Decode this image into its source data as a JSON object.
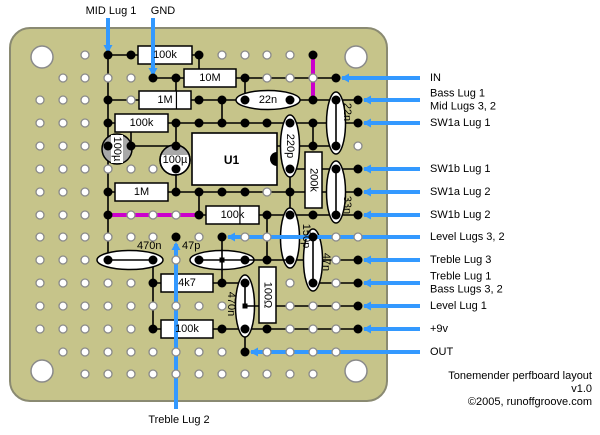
{
  "meta": {
    "title_line1": "Tonemender perfboard layout",
    "title_line2": "v1.0",
    "title_line3": "©2005, runoffgroove.com"
  },
  "colors": {
    "board": "#C6C48A",
    "board_edge": "#8A8A72",
    "trace": "#000000",
    "jumper": "#CC00CC",
    "lead": "#3399FF",
    "hole_ring": "#8A8A8A",
    "hole_fill": "#FFFFFF",
    "dot": "#000000",
    "component_fill": "#FFFFFF",
    "crescent": "#A8A8A8",
    "text": "#000000"
  },
  "board": {
    "x": 10,
    "y": 28,
    "w": 377,
    "h": 373,
    "r": 20,
    "screws": [
      [
        42,
        57
      ],
      [
        356,
        57
      ],
      [
        42,
        371
      ],
      [
        356,
        371
      ]
    ],
    "screw_r": 11
  },
  "grid": {
    "cols": [
      40,
      63,
      85,
      108,
      131,
      153,
      176,
      199,
      222,
      245,
      267,
      290,
      313,
      336,
      358
    ],
    "rows": [
      55,
      78,
      100,
      123,
      146,
      169,
      192,
      215,
      237,
      260,
      283,
      306,
      329,
      352,
      374
    ],
    "hole_r": 4,
    "skip": [
      [
        0,
        0
      ],
      [
        1,
        0
      ],
      [
        0,
        1
      ],
      [
        13,
        0
      ],
      [
        14,
        0
      ],
      [
        14,
        1
      ],
      [
        0,
        13
      ],
      [
        0,
        14
      ],
      [
        1,
        14
      ],
      [
        14,
        13
      ],
      [
        13,
        14
      ],
      [
        14,
        14
      ],
      [
        5,
        4
      ]
    ]
  },
  "traces_under": [
    [
      108,
      55,
      199,
      55
    ],
    [
      153,
      78,
      336,
      78
    ],
    [
      108,
      100,
      358,
      100
    ],
    [
      108,
      123,
      358,
      123
    ],
    [
      108,
      146,
      176,
      146
    ],
    [
      277,
      146,
      336,
      146
    ],
    [
      290,
      169,
      358,
      169
    ],
    [
      108,
      192,
      358,
      192
    ],
    [
      199,
      215,
      358,
      215
    ],
    [
      153,
      283,
      245,
      283
    ],
    [
      290,
      260,
      358,
      260
    ],
    [
      313,
      283,
      358,
      283
    ],
    [
      153,
      329,
      358,
      329
    ],
    [
      108,
      55,
      108,
      260
    ],
    [
      131,
      123,
      131,
      146
    ],
    [
      153,
      260,
      153,
      329
    ],
    [
      176,
      78,
      176,
      100
    ],
    [
      176,
      123,
      176,
      192
    ],
    [
      199,
      55,
      199,
      78
    ],
    [
      199,
      192,
      199,
      215
    ],
    [
      222,
      100,
      222,
      123
    ],
    [
      245,
      78,
      245,
      100
    ],
    [
      245,
      329,
      245,
      352
    ],
    [
      267,
      215,
      267,
      260
    ],
    [
      290,
      169,
      290,
      215
    ],
    [
      313,
      123,
      313,
      146
    ]
  ],
  "traces_over": [
    [
      108,
      260,
      153,
      260
    ],
    [
      199,
      260,
      290,
      260
    ],
    [
      222,
      237,
      222,
      283
    ],
    [
      336,
      100,
      336,
      146
    ],
    [
      336,
      169,
      336,
      215
    ],
    [
      313,
      237,
      313,
      283
    ],
    [
      245,
      283,
      245,
      306
    ],
    [
      245,
      306,
      358,
      306
    ]
  ],
  "jumpers": [
    [
      313,
      55,
      313,
      100
    ],
    [
      108,
      215,
      199,
      215
    ]
  ],
  "dots": [
    [
      108,
      55
    ],
    [
      131,
      55
    ],
    [
      199,
      55
    ],
    [
      313,
      55
    ],
    [
      153,
      78
    ],
    [
      176,
      78
    ],
    [
      245,
      78
    ],
    [
      336,
      78
    ],
    [
      108,
      100
    ],
    [
      199,
      100
    ],
    [
      222,
      100
    ],
    [
      245,
      100
    ],
    [
      290,
      100
    ],
    [
      313,
      100
    ],
    [
      336,
      100
    ],
    [
      358,
      100
    ],
    [
      108,
      123
    ],
    [
      176,
      123
    ],
    [
      199,
      123
    ],
    [
      222,
      123
    ],
    [
      245,
      123
    ],
    [
      267,
      123
    ],
    [
      290,
      123
    ],
    [
      313,
      123
    ],
    [
      358,
      123
    ],
    [
      108,
      146
    ],
    [
      131,
      146
    ],
    [
      176,
      146
    ],
    [
      313,
      146
    ],
    [
      336,
      146
    ],
    [
      176,
      169
    ],
    [
      290,
      169
    ],
    [
      336,
      169
    ],
    [
      358,
      169
    ],
    [
      108,
      192
    ],
    [
      176,
      192
    ],
    [
      199,
      192
    ],
    [
      222,
      192
    ],
    [
      245,
      192
    ],
    [
      290,
      192
    ],
    [
      358,
      192
    ],
    [
      108,
      215
    ],
    [
      199,
      215
    ],
    [
      267,
      215
    ],
    [
      290,
      215
    ],
    [
      313,
      215
    ],
    [
      336,
      215
    ],
    [
      358,
      215
    ],
    [
      176,
      237
    ],
    [
      222,
      237
    ],
    [
      313,
      237
    ],
    [
      108,
      260
    ],
    [
      153,
      260
    ],
    [
      199,
      260
    ],
    [
      245,
      260
    ],
    [
      267,
      260
    ],
    [
      290,
      260
    ],
    [
      358,
      260
    ],
    [
      153,
      283
    ],
    [
      222,
      283
    ],
    [
      245,
      283
    ],
    [
      313,
      283
    ],
    [
      358,
      283
    ],
    [
      358,
      306
    ],
    [
      153,
      329
    ],
    [
      222,
      329
    ],
    [
      245,
      329
    ],
    [
      267,
      329
    ],
    [
      358,
      329
    ],
    [
      245,
      352
    ]
  ],
  "junctions": [
    [
      222,
      260
    ],
    [
      245,
      306
    ]
  ],
  "components": {
    "resistors_h": [
      {
        "label": "100k",
        "x": 138,
        "y": 46,
        "w": 54,
        "h": 18
      },
      {
        "label": "10M",
        "x": 184,
        "y": 69,
        "w": 52,
        "h": 18
      },
      {
        "label": "1M",
        "x": 139,
        "y": 91,
        "w": 52,
        "h": 18,
        "divider": 0.72
      },
      {
        "label": "100k",
        "x": 115,
        "y": 114,
        "w": 53,
        "h": 18
      },
      {
        "label": "1M",
        "x": 115,
        "y": 183,
        "w": 53,
        "h": 18
      },
      {
        "label": "100k",
        "x": 206,
        "y": 206,
        "w": 53,
        "h": 18,
        "divider": 0.64
      },
      {
        "label": "4k7",
        "x": 161,
        "y": 274,
        "w": 52,
        "h": 18
      },
      {
        "label": "100k",
        "x": 161,
        "y": 320,
        "w": 52,
        "h": 18
      }
    ],
    "resistors_v": [
      {
        "label": "200k",
        "x": 305,
        "y": 152,
        "w": 17,
        "h": 56
      },
      {
        "label": "100Ω",
        "x": 259,
        "y": 267,
        "w": 17,
        "h": 56
      }
    ],
    "caps_h": [
      {
        "label": "22n",
        "cx": 268,
        "cy": 100,
        "rx": 32,
        "ry": 9.5,
        "inside": true
      },
      {
        "label": "470n",
        "cx": 130,
        "cy": 260,
        "rx": 33,
        "ry": 9.5,
        "label_x": 137,
        "label_y": 250
      },
      {
        "label": "47p",
        "cx": 222,
        "cy": 260,
        "rx": 32,
        "ry": 9.5,
        "label_x": 182,
        "label_y": 250
      }
    ],
    "caps_v": [
      {
        "label": "220p",
        "cx": 290,
        "cy": 146,
        "rx": 9.5,
        "ry": 31,
        "inside": true
      },
      {
        "label": "150p",
        "cx": 290,
        "cy": 238,
        "rx": 9.5,
        "ry": 30,
        "label_cx": 306,
        "label_cy": 236
      },
      {
        "label": "22n",
        "cx": 336,
        "cy": 123,
        "rx": 9.5,
        "ry": 31,
        "label_cx": 347,
        "label_cy": 112
      },
      {
        "label": "33n",
        "cx": 336,
        "cy": 192,
        "rx": 9.5,
        "ry": 31,
        "label_cx": 347,
        "label_cy": 205
      },
      {
        "label": "47n",
        "cx": 313,
        "cy": 260,
        "rx": 9.5,
        "ry": 31,
        "label_cx": 326,
        "label_cy": 262
      },
      {
        "label": "470n",
        "cx": 245,
        "cy": 306,
        "rx": 9.5,
        "ry": 31,
        "label_cx": 231,
        "label_cy": 304
      }
    ],
    "electrolytics": [
      {
        "label": "100µ",
        "cx": 117,
        "cy": 149,
        "r": 15,
        "vert": true,
        "crescent": "sides"
      },
      {
        "label": "100µ",
        "cx": 175,
        "cy": 160,
        "r": 15,
        "vert": false,
        "crescent": "top"
      }
    ],
    "ic": {
      "label": "U1",
      "x": 192,
      "y": 133,
      "w": 85,
      "h": 52,
      "notch_r": 7
    }
  },
  "pin_labels": [
    {
      "name": "mid-lug-1",
      "lines": [
        "MID Lug 1"
      ],
      "lx": 111,
      "ly": 11,
      "anchor": "middle",
      "line": [
        108,
        18,
        108,
        51
      ],
      "arrow": "down"
    },
    {
      "name": "gnd",
      "lines": [
        "GND"
      ],
      "lx": 163,
      "ly": 11,
      "anchor": "middle",
      "line": [
        153,
        18,
        153,
        74
      ],
      "arrow": "down"
    },
    {
      "name": "in",
      "lines": [
        "IN"
      ],
      "lx": 430,
      "ly": 78,
      "anchor": "start",
      "line": [
        420,
        78,
        342,
        78
      ],
      "arrow": "left"
    },
    {
      "name": "bass-lug-1-mid-lugs-3-2",
      "lines": [
        "Bass Lug 1",
        "Mid Lugs 3, 2"
      ],
      "lx": 430,
      "ly": 100,
      "anchor": "start",
      "line": [
        420,
        100,
        364,
        100
      ],
      "arrow": "left"
    },
    {
      "name": "sw1a-lug-1",
      "lines": [
        "SW1a Lug 1"
      ],
      "lx": 430,
      "ly": 123,
      "anchor": "start",
      "line": [
        420,
        123,
        364,
        123
      ],
      "arrow": "left"
    },
    {
      "name": "sw1b-lug-1",
      "lines": [
        "SW1b Lug 1"
      ],
      "lx": 430,
      "ly": 169,
      "anchor": "start",
      "line": [
        420,
        169,
        364,
        169
      ],
      "arrow": "left"
    },
    {
      "name": "sw1a-lug-2",
      "lines": [
        "SW1a Lug 2"
      ],
      "lx": 430,
      "ly": 192,
      "anchor": "start",
      "line": [
        420,
        192,
        364,
        192
      ],
      "arrow": "left"
    },
    {
      "name": "sw1b-lug-2",
      "lines": [
        "SW1b Lug 2"
      ],
      "lx": 430,
      "ly": 215,
      "anchor": "start",
      "line": [
        420,
        215,
        364,
        215
      ],
      "arrow": "left"
    },
    {
      "name": "level-lugs-3-2",
      "lines": [
        "Level Lugs 3, 2"
      ],
      "lx": 430,
      "ly": 237,
      "anchor": "start",
      "line": [
        420,
        237,
        228,
        237
      ],
      "arrow": "left"
    },
    {
      "name": "treble-lug-3",
      "lines": [
        "Treble Lug 3"
      ],
      "lx": 430,
      "ly": 260,
      "anchor": "start",
      "line": [
        420,
        260,
        364,
        260
      ],
      "arrow": "left"
    },
    {
      "name": "treble-lug-1-bass-lugs-3-2",
      "lines": [
        "Treble Lug 1",
        "Bass Lugs 3, 2"
      ],
      "lx": 430,
      "ly": 283,
      "anchor": "start",
      "line": [
        420,
        283,
        364,
        283
      ],
      "arrow": "left"
    },
    {
      "name": "level-lug-1",
      "lines": [
        "Level Lug 1"
      ],
      "lx": 430,
      "ly": 306,
      "anchor": "start",
      "line": [
        420,
        306,
        364,
        306
      ],
      "arrow": "left"
    },
    {
      "name": "plus-9v",
      "lines": [
        "+9v"
      ],
      "lx": 430,
      "ly": 329,
      "anchor": "start",
      "line": [
        420,
        329,
        364,
        329
      ],
      "arrow": "left"
    },
    {
      "name": "out",
      "lines": [
        "OUT"
      ],
      "lx": 430,
      "ly": 352,
      "anchor": "start",
      "line": [
        420,
        352,
        251,
        352
      ],
      "arrow": "left"
    },
    {
      "name": "treble-lug-2",
      "lines": [
        "Treble Lug 2"
      ],
      "lx": 179,
      "ly": 420,
      "anchor": "middle",
      "line": [
        176,
        409,
        176,
        244
      ],
      "arrow": "up"
    }
  ]
}
